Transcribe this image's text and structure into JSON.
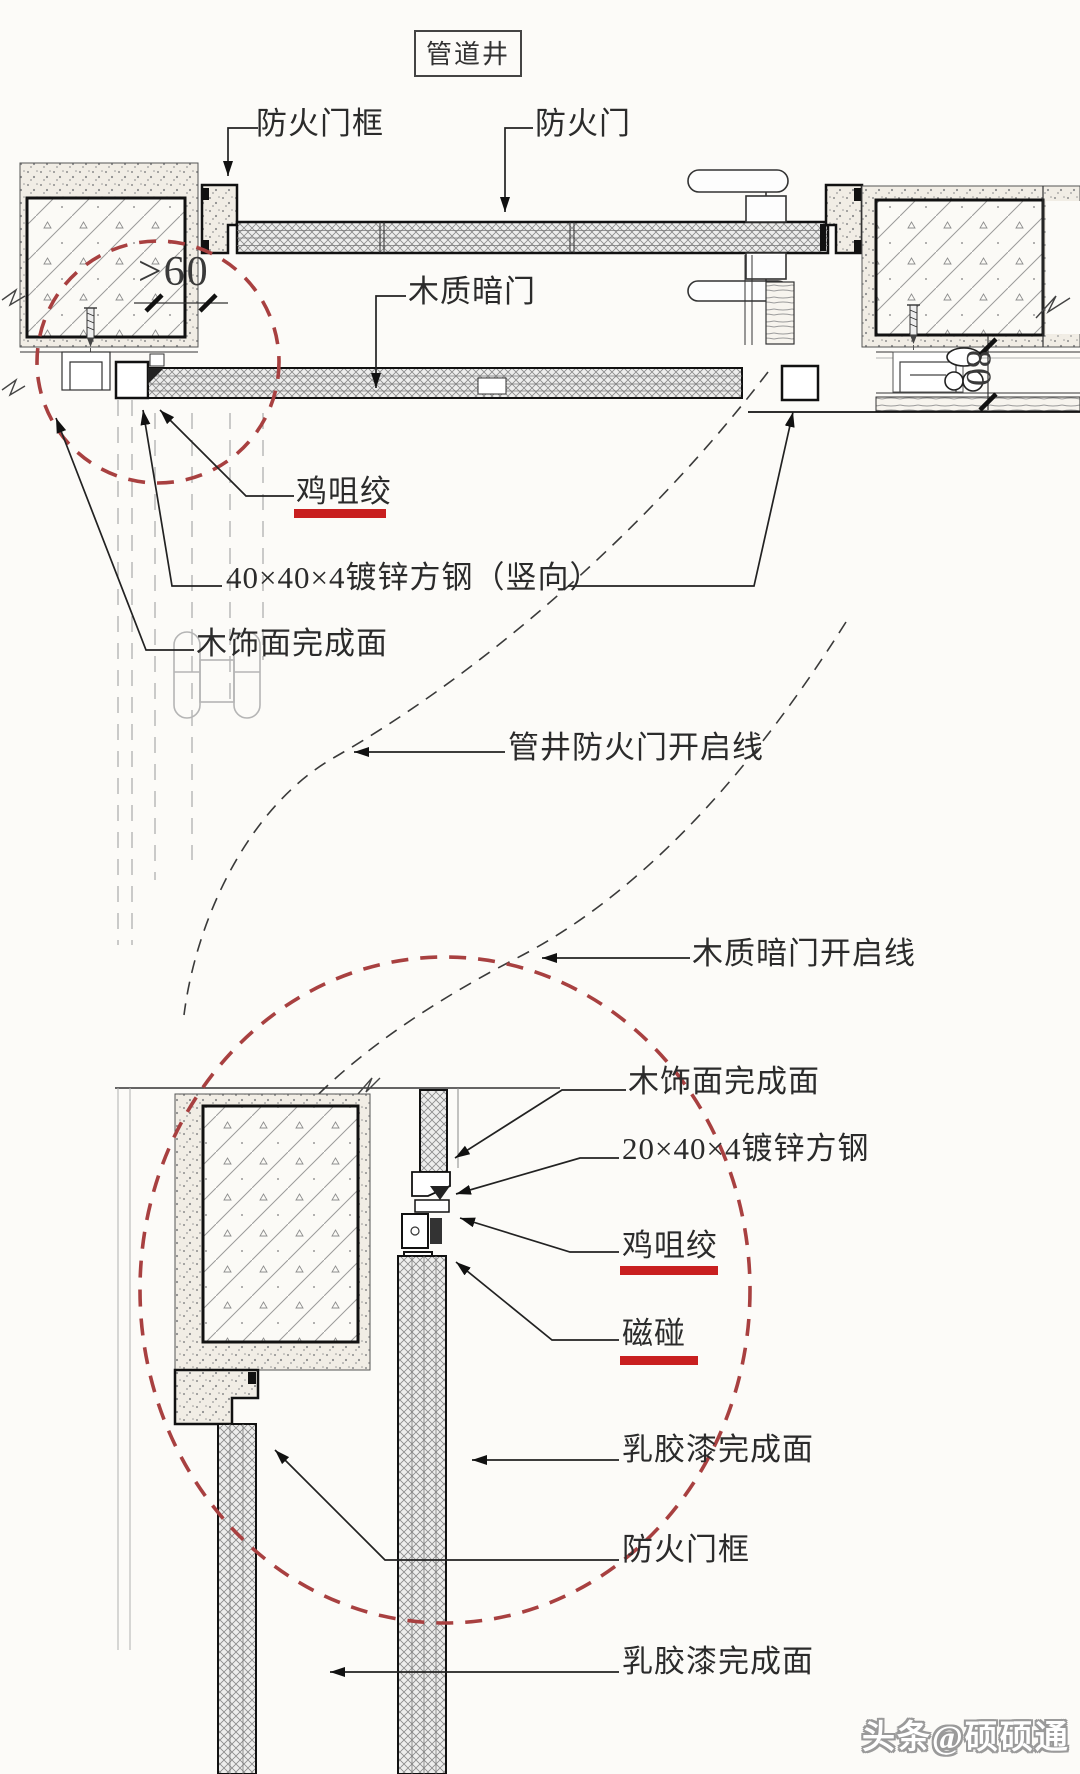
{
  "drawing": {
    "title": "管道井",
    "plan_view": {
      "fire_door_frame": "防火门框",
      "fire_door": "防火门",
      "wood_hidden_door": "木质暗门",
      "chicken_beak_joint": "鸡咀绞",
      "steel_tube_vertical": "40×40×4镀锌方钢（竖向）",
      "wood_veneer_finish": "木饰面完成面",
      "fire_door_swing_line": "管井防火门开启线",
      "hidden_door_swing_line": "木质暗门开启线",
      "dim_left": "&gt;60",
      "dim_left_text": ">60",
      "dim_right": "80"
    },
    "section_view": {
      "wood_veneer_finish": "木饰面完成面",
      "steel_tube": "20×40×4镀锌方钢",
      "chicken_beak_joint": "鸡咀绞",
      "magnetic_catch": "磁碰",
      "latex_paint_finish_1": "乳胶漆完成面",
      "fire_door_frame": "防火门框",
      "latex_paint_finish_2": "乳胶漆完成面"
    },
    "colors": {
      "highlight_circle_red": "#a84040",
      "underline_red": "#c81f1f",
      "line_black": "#1c1c1c"
    },
    "watermark": "头条@硕硕通"
  }
}
